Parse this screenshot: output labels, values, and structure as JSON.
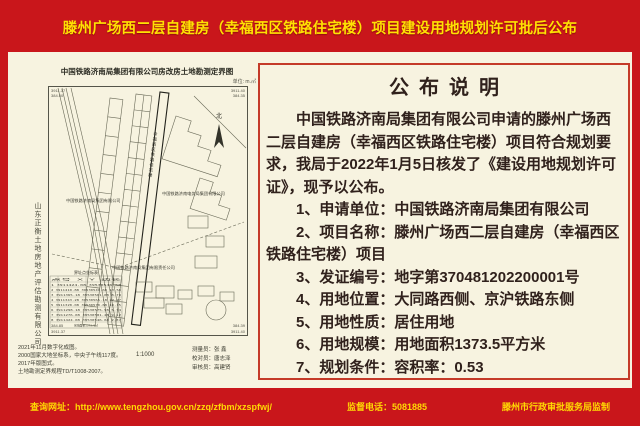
{
  "header": {
    "title": "滕州广场西二层自建房（幸福西区铁路住宅楼）项目建设用地规划许可批后公布"
  },
  "colors": {
    "background_red": "#c9161b",
    "title_yellow": "#ffe103",
    "panel_cream": "#f7f3e0",
    "panel_border_red": "#c43a28",
    "body_text": "#30211c",
    "footer_yellow": "#ffd903"
  },
  "map": {
    "title": "中国铁路济南局集团有限公司房改房土地勘测定界图",
    "unit_label": "单位: m.㎡",
    "north_label": "北",
    "company_vertical": "山东正衡土地房地产评估勘测有限公司",
    "scale": "1:1000",
    "corner": {
      "tl1": "3911.37",
      "tl2": "384.50",
      "tr1": "3911.40",
      "tr2": "384.35",
      "bl1": "384.85",
      "bl2": "3911.37",
      "br1": "384.39",
      "br2": "3911.40"
    },
    "labels": {
      "l1": "中国铁路济南局集团有限公司",
      "l2": "中国铁路济南电务局集团有限公司",
      "l3": "中国铁路济南局集团有限责任公司",
      "strip": "幸福西区铁路住宅楼"
    },
    "table": {
      "title": "界址点坐标表",
      "header": "点号    X         Y        边长",
      "rows": [
        "1  3911424.08  39530546.68",
        "2  3911410.88  39530549.68  13.58",
        "3  3911365.18  39530561.08   8.79",
        "4  3911343.28  39530565.18  22.27",
        "5  3911320.08  39530570.68  10.15",
        "6  3911298.18  39530575.98   5.74",
        "7  3911276.08  39530581.28   9.12",
        "8  3911424.08  39530546.68   2.37"
      ],
      "footer": "宗地面积1373.5㎡"
    },
    "notes": [
      "2021年11月数字化成图。",
      "2000国家大地坐标系，中央子午线117度。",
      "2017年版图式。",
      "土地勘测定界规程TD/T1008-2007。"
    ],
    "staff": [
      "测量员：张  鑫",
      "校对员：唐志泽",
      "审核员：高建贤"
    ]
  },
  "announcement": {
    "title": "公布说明",
    "paragraph": "中国铁路济南局集团有限公司申请的滕州广场西二层自建房（幸福西区铁路住宅楼）项目符合规划要求，我局于2022年1月5日核发了《建设用地规划许可证》，现予以公布。",
    "items": [
      "1、申请单位：中国铁路济南局集团有限公司",
      "2、项目名称：滕州广场西二层自建房（幸福西区铁路住宅楼）项目",
      "3、发证编号：地字第370481202200001号",
      "4、用地位置：大同路西侧、京沪铁路东侧",
      "5、用地性质：居住用地",
      "6、用地规模：用地面积1373.5平方米",
      "7、规划条件：容积率：0.53"
    ]
  },
  "footer": {
    "website_label": "查询网址：http://www.tengzhou.gov.cn/zzq/zfbm/xzspfwj/",
    "phone_label": "监督电话：5081885",
    "producer": "滕州市行政审批服务局监制"
  }
}
